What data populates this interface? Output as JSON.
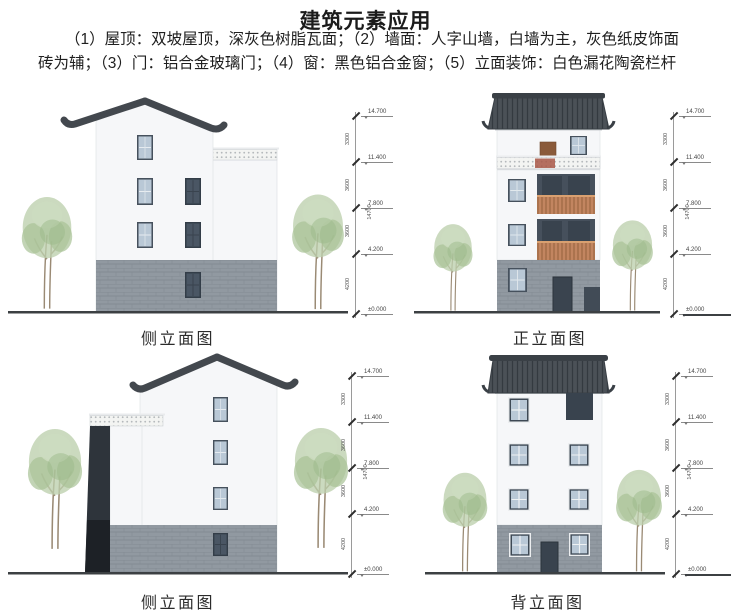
{
  "header": {
    "title": "建筑元素应用",
    "description": "（1）屋顶：双坡屋顶，深灰色树脂瓦面；（2）墙面：人字山墙，白墙为主，灰色纸皮饰面砖为辅；（3）门：铝合金玻璃门；（4）窗：黑色铝合金窗；（5）立面装饰：白色漏花陶瓷栏杆"
  },
  "elevations": {
    "side_top": {
      "caption": "侧立面图"
    },
    "front": {
      "caption": "正立面图"
    },
    "side_bottom": {
      "caption": "侧立面图"
    },
    "back": {
      "caption": "背立面图"
    }
  },
  "dimensions": {
    "levels": [
      "14.700",
      "11.400",
      "7.800",
      "4.200",
      "±0.000"
    ],
    "segments": [
      "3300",
      "3600",
      "3600",
      "4200"
    ],
    "total": "14700"
  },
  "colors": {
    "roof_dark_gray": "#43484e",
    "wall_white": "#f6f7f9",
    "brick_gray": "#9199a1",
    "window_glass_blue": "#b9c8d6",
    "balcony_rail_wood": "#c28560",
    "tree_green": "#bccfad",
    "ground_dark": "#3c4043"
  }
}
